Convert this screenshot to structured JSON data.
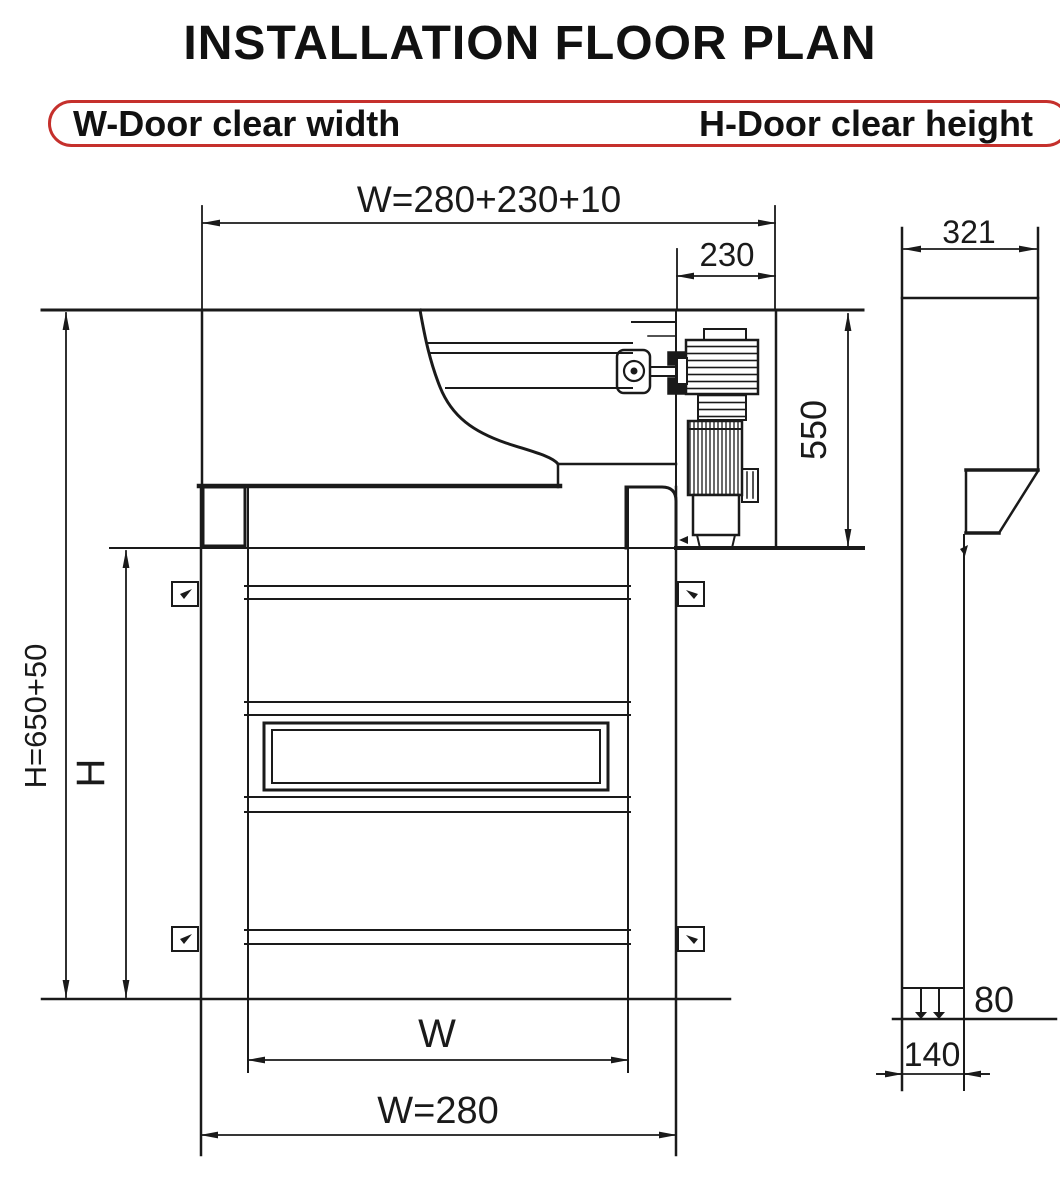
{
  "title": "INSTALLATION FLOOR PLAN",
  "legend": {
    "width_label": "W-Door clear width",
    "height_label": "H-Door clear height"
  },
  "dimensions": {
    "total_width": "W=280+230+10",
    "motor_side_offset": "230",
    "side_depth": "321",
    "header_height": "550",
    "total_height": "H=650+50",
    "clear_height": "H",
    "clear_width": "W",
    "frame_width": "W=280",
    "floor_clearance": "80",
    "rail_depth": "140"
  },
  "colors": {
    "ink": "#1a1a1a",
    "accent_red": "#c5302c",
    "background": "#ffffff"
  }
}
